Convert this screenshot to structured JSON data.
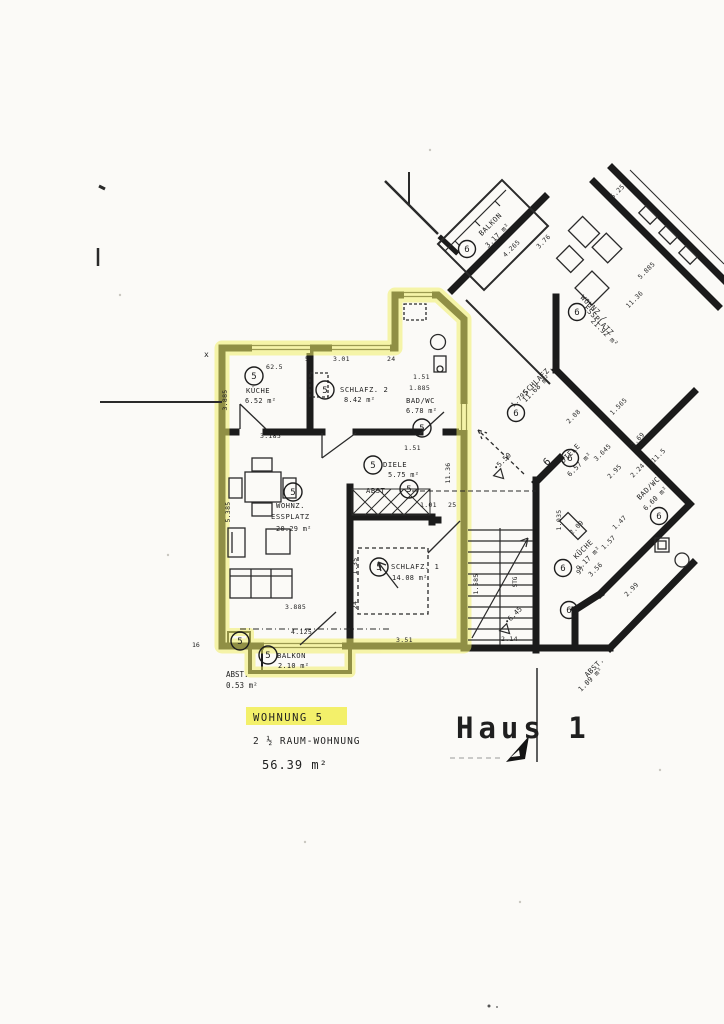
{
  "page": {
    "building_title": "Haus 1",
    "highlight_color": "#f1ee68"
  },
  "apt5": {
    "number": "5",
    "rooms": {
      "kueche": {
        "name": "KÜCHE",
        "area": "6.52 m²"
      },
      "schlafz2": {
        "name": "SCHLAFZ. 2",
        "area": "8.42 m²"
      },
      "bad": {
        "name": "BAD/WC",
        "area": "6.78 m²"
      },
      "diele": {
        "name": "DIELE",
        "area": "5.75 m²"
      },
      "abst": {
        "name": "ABST."
      },
      "wohnz": {
        "line1": "WOHNZ.",
        "line2": "ESSPLATZ",
        "area": "20.29 m²"
      },
      "schlafz1": {
        "name": "SCHLAFZ. 1",
        "area": "14.08 m²"
      },
      "balkon": {
        "name": "BALKON",
        "area": "2.10 m²"
      },
      "abst_balkon": {
        "name": "ABST.",
        "area": "0.53 m²"
      }
    },
    "dims": {
      "left_upper": "3.885",
      "left_lower": "5.385",
      "kueche_top": "62.5",
      "top_a": "5",
      "top_b": "3.01",
      "top_c": "24",
      "kueche_bottom": "3.185",
      "bad_w": "1.51",
      "bad_d": "1.885",
      "diele_top": "1.51",
      "right_mid": "11.36",
      "abst_a": "1.01",
      "abst_b": "25",
      "schlafz1_left_a": "1.35",
      "schlafz1_left_b": "24",
      "schlafz1_bottom": "3.51",
      "wohnz_bottom_a": "3.885",
      "wohnz_bottom_b": "4.125",
      "right_lower": "1.585"
    },
    "footer": {
      "label": "WOHNUNG 5",
      "type": "2 ½ RAUM-WOHNUNG",
      "area": "56.39 m²"
    }
  },
  "apt6": {
    "number": "6",
    "rooms": {
      "balkon": {
        "name": "BALKON",
        "area": "3.17 m²"
      },
      "wohnz": {
        "line1": "WOHNZ /",
        "line2": "ESSPLATZ",
        "area": "21.92 m²"
      },
      "schlafz2": {
        "name": "SCHLAFZ. 2",
        "area": "11.68 m²"
      },
      "diele": {
        "name": "DIELE",
        "area": "6.57 m²"
      },
      "bad": {
        "name": "BAD/WC",
        "area": "6.60 m²"
      },
      "kueche": {
        "name": "KÜCHE",
        "area": "9.17 m²"
      },
      "abst": {
        "name": "ABST.",
        "area": "1.09 m²"
      }
    },
    "dims": {
      "balkon": "4.265",
      "wohnz_a": "3.76",
      "top_right_a": "5.25",
      "top_right_b": "5.885",
      "wall": "11.36",
      "schlafz": "1.795",
      "diele_a": "2.08",
      "diele_b": "1.565",
      "diele_c": "3.645",
      "right_a": "5.69",
      "right_b": "11.5",
      "bad_a": "2.95",
      "bad_b": "2.24",
      "kueche_a": "2.09",
      "kueche_b": "3.56",
      "kueche_c": "1.47",
      "kueche_d": "1.57",
      "kueche_e": "97",
      "kueche_f": "1.035",
      "edge": "2.99",
      "stairs_bottom": "2.14"
    }
  },
  "markers": {
    "upper": "•5.50",
    "lower": "•6.45"
  },
  "stairs": {
    "label": "STG"
  },
  "misc": {
    "x_mark": "x",
    "sixteen": "16",
    "six": "6"
  }
}
